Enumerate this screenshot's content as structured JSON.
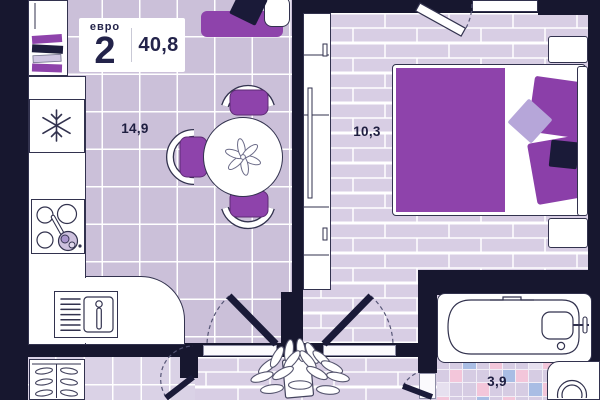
{
  "header": {
    "plan_type_label": "евро",
    "plan_rooms_count": "2",
    "plan_total_area": "40,8"
  },
  "rooms": [
    {
      "id": "kitchen-living-room",
      "area_label": "14,9"
    },
    {
      "id": "bedroom",
      "area_label": "10,3"
    },
    {
      "id": "bathroom",
      "area_label": "3,9"
    }
  ],
  "palette": {
    "wall": "#17172f",
    "furniture_purple": "#8e43ab",
    "lavender_accent": "#b6a6d9",
    "navy_pillow": "#1a1a38",
    "living_floor_tile": "#cbc0d9",
    "entry_floor_tile": "#dad2e6",
    "plank_floor": "#d8cee4",
    "outline": "#32324e"
  },
  "bathroom_tiles": {
    "palette": {
      "L": "#d6cce3",
      "P": "#f3c6da",
      "B": "#a9bde4",
      "W": "#e6e0ef"
    },
    "rows": [
      "LLBLPLLWP",
      "LPLLLBPLL",
      "WLLPLLLBP",
      "PLLBLPLLL"
    ]
  },
  "icons": {
    "fridge": "snowflake-icon",
    "stove": "burners-icon",
    "plant": "plant-icon",
    "flower": "flower-icon"
  }
}
